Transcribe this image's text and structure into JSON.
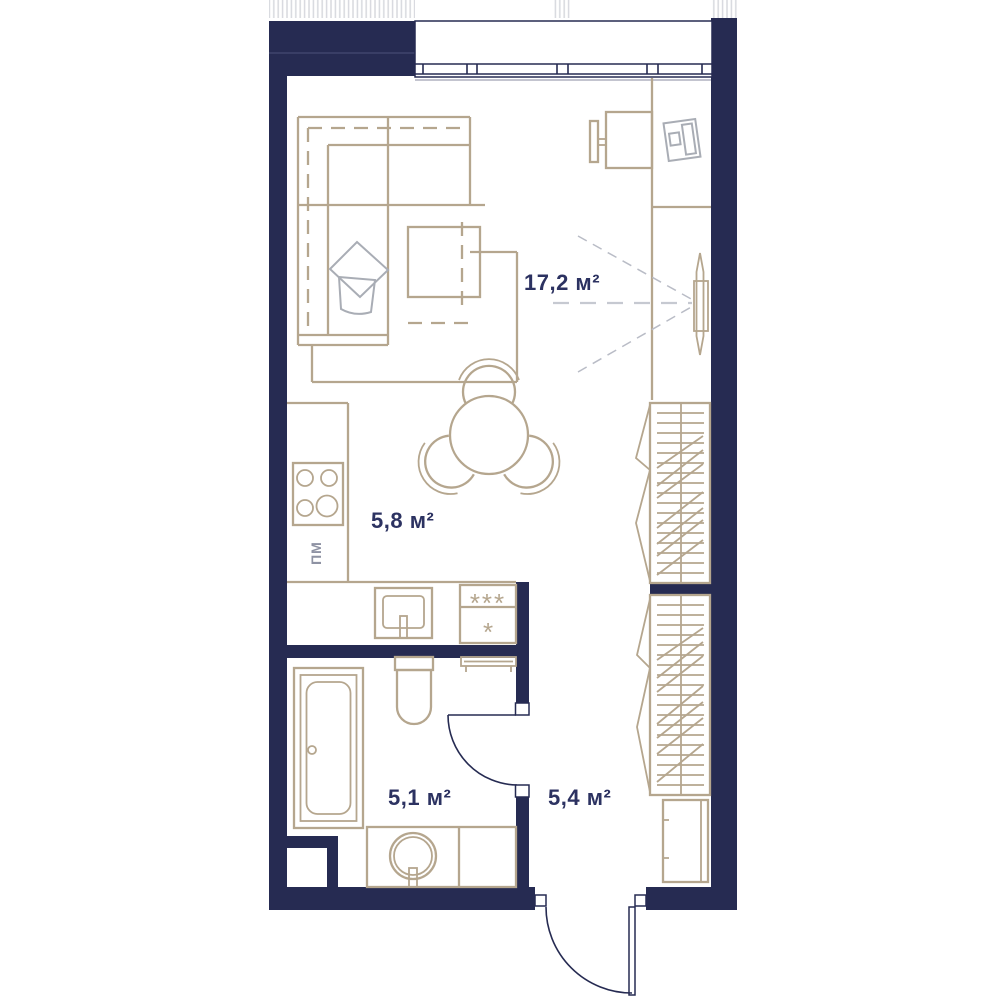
{
  "plan": {
    "rooms": [
      {
        "name": "living-room",
        "area_label": "17,2 м²"
      },
      {
        "name": "kitchen",
        "area_label": "5,8 м²"
      },
      {
        "name": "bathroom",
        "area_label": "5,1 м²"
      },
      {
        "name": "hallway",
        "area_label": "5,4 м²"
      }
    ],
    "appliance_labels": {
      "dishwasher": "ПМ",
      "freezer_compartment": "***",
      "fridge_compartment": "*"
    },
    "colors": {
      "wall": "#262b52",
      "furniture_outline": "#b5a68e",
      "soft_furniture": "#a9adb5",
      "sight_lines": "#c6c9d1",
      "label_text": "#2c3261",
      "background": "#ffffff"
    }
  }
}
